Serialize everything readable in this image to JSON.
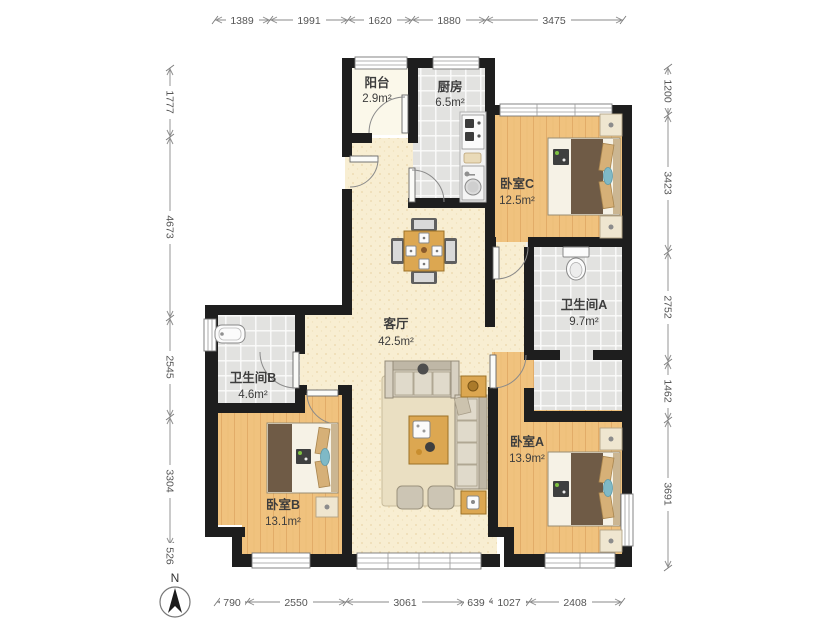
{
  "rooms": {
    "living": {
      "name": "客厅",
      "area": "42.5m²"
    },
    "kitchen": {
      "name": "厨房",
      "area": "6.5m²"
    },
    "balcony": {
      "name": "阳台",
      "area": "2.9m²"
    },
    "bedroom_a": {
      "name": "卧室A",
      "area": "13.9m²"
    },
    "bedroom_b": {
      "name": "卧室B",
      "area": "13.1m²"
    },
    "bedroom_c": {
      "name": "卧室C",
      "area": "12.5m²"
    },
    "bathroom_a": {
      "name": "卫生间A",
      "area": "9.7m²"
    },
    "bathroom_b": {
      "name": "卫生间B",
      "area": "4.6m²"
    }
  },
  "dimensions_mm": {
    "top": [
      "1389",
      "1991",
      "1620",
      "1880",
      "3475"
    ],
    "bottom": [
      "790",
      "2550",
      "3061",
      "639",
      "1027",
      "2408"
    ],
    "left": [
      "1777",
      "4673",
      "2545",
      "3304",
      "526"
    ],
    "right": [
      "1200",
      "3423",
      "2752",
      "1462",
      "3691"
    ]
  },
  "compass": {
    "label": "N"
  }
}
